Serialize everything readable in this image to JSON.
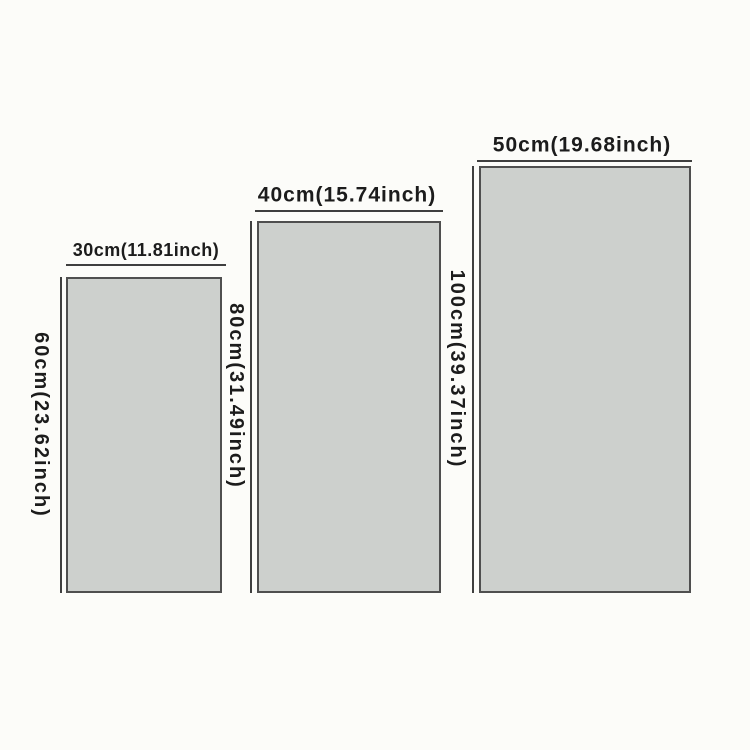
{
  "diagram": {
    "background_color": "#fcfcf9",
    "panel_fill_color": "#cdd0cd",
    "panel_border_color": "#4f4f4f",
    "dimension_line_color": "#3f3f3f",
    "text_color": "#1c1c1c",
    "panels": [
      {
        "id": "small",
        "width_label": "30cm(11.81inch)",
        "height_label": "60cm(23.62inch)",
        "width_cm": 30,
        "height_cm": 60,
        "width_inch": 11.81,
        "height_inch": 23.62
      },
      {
        "id": "medium",
        "width_label": "40cm(15.74inch)",
        "height_label": "80cm(31.49inch)",
        "width_cm": 40,
        "height_cm": 80,
        "width_inch": 15.74,
        "height_inch": 31.49
      },
      {
        "id": "large",
        "width_label": "50cm(19.68inch)",
        "height_label": "100cm(39.37inch)",
        "width_cm": 50,
        "height_cm": 100,
        "width_inch": 19.68,
        "height_inch": 39.37
      }
    ]
  }
}
